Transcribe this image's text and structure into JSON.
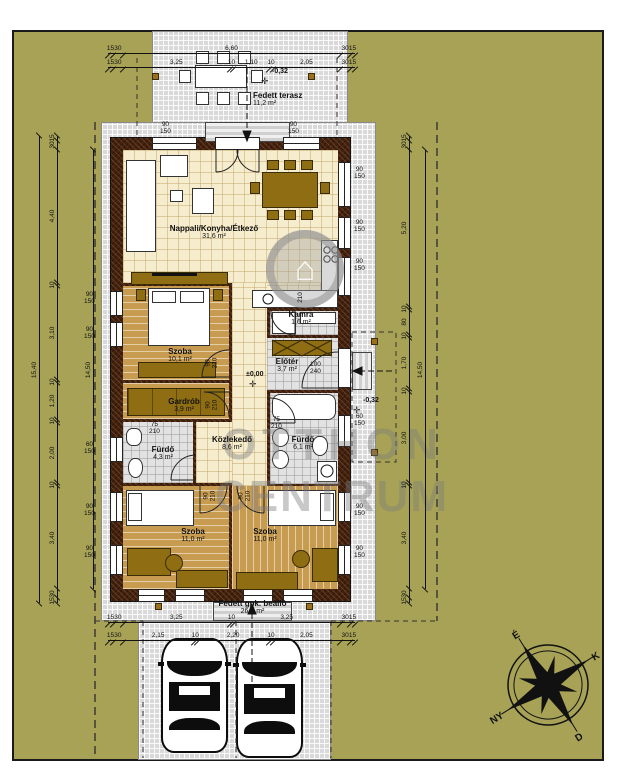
{
  "drawing": {
    "type": "floor-plan"
  },
  "colors": {
    "ground": "#a7a256",
    "paving": "#d9d9d9",
    "wall": "#45200a",
    "wood": "#c89c50",
    "cream": "#f6ecce",
    "furniture": "#8f6d12"
  },
  "rooms": [
    {
      "name": "Fedett terasz",
      "area": "11,2 m²"
    },
    {
      "name": "Nappali/Konyha/Étkező",
      "area": "31,6 m²"
    },
    {
      "name": "Szoba",
      "area": "10,1 m²"
    },
    {
      "name": "Gardrób",
      "area": "3,9 m²"
    },
    {
      "name": "Fürdő",
      "area": "4,3 m²"
    },
    {
      "name": "Közlekedő",
      "area": "8,6 m²"
    },
    {
      "name": "Kamra",
      "area": "1,6 m²"
    },
    {
      "name": "Előtér",
      "area": "3,7 m²"
    },
    {
      "name": "Fürdő",
      "area": "6,1 m²"
    },
    {
      "name": "Szoba",
      "area": "11,0 m²"
    },
    {
      "name": "Szoba",
      "area": "11,0 m²"
    },
    {
      "name": "Fedett gpk. beálló",
      "area": "26,7 m²"
    }
  ],
  "levels": [
    {
      "label": "-0,32",
      "mark": "✛"
    },
    {
      "label": "±0,00",
      "mark": "✛"
    },
    {
      "label": "-0,32",
      "mark": "✛"
    }
  ],
  "dimensions": {
    "top_outer": {
      "segments": [
        {
          "l": "15",
          "v": 15
        },
        {
          "l": "30",
          "v": 30
        },
        {
          "l": "6,60",
          "v": 660
        },
        {
          "l": "30",
          "v": 30
        },
        {
          "l": "15",
          "v": 15
        }
      ]
    },
    "top_inner": {
      "segments": [
        {
          "l": "15",
          "v": 15
        },
        {
          "l": "30",
          "v": 30
        },
        {
          "l": "3,25",
          "v": 325
        },
        {
          "l": "10",
          "v": 10
        },
        {
          "l": "1,10",
          "v": 110
        },
        {
          "l": "10",
          "v": 10
        },
        {
          "l": "2,05",
          "v": 205
        },
        {
          "l": "30",
          "v": 30
        },
        {
          "l": "15",
          "v": 15
        }
      ]
    },
    "bottom_outer": {
      "segments": [
        {
          "l": "15",
          "v": 15
        },
        {
          "l": "30",
          "v": 30
        },
        {
          "l": "3,25",
          "v": 325
        },
        {
          "l": "10",
          "v": 10
        },
        {
          "l": "3,25",
          "v": 325
        },
        {
          "l": "30",
          "v": 30
        },
        {
          "l": "15",
          "v": 15
        }
      ]
    },
    "bottom_inner": {
      "segments": [
        {
          "l": "15",
          "v": 15
        },
        {
          "l": "30",
          "v": 30
        },
        {
          "l": "2,15",
          "v": 215
        },
        {
          "l": "10",
          "v": 10
        },
        {
          "l": "2,20",
          "v": 220
        },
        {
          "l": "10",
          "v": 10
        },
        {
          "l": "2,05",
          "v": 205
        },
        {
          "l": "30",
          "v": 30
        },
        {
          "l": "15",
          "v": 15
        }
      ]
    },
    "left_detail": {
      "segments": [
        {
          "l": "15",
          "v": 15
        },
        {
          "l": "30",
          "v": 30
        },
        {
          "l": "4,40",
          "v": 440
        },
        {
          "l": "10",
          "v": 10
        },
        {
          "l": "3,10",
          "v": 310
        },
        {
          "l": "10",
          "v": 10
        },
        {
          "l": "1,20",
          "v": 120
        },
        {
          "l": "10",
          "v": 10
        },
        {
          "l": "2,00",
          "v": 200
        },
        {
          "l": "10",
          "v": 10
        },
        {
          "l": "3,40",
          "v": 340
        },
        {
          "l": "30",
          "v": 30
        },
        {
          "l": "15",
          "v": 15
        }
      ]
    },
    "left_total_outer": {
      "segments": [
        {
          "l": "15,40",
          "v": 1540
        }
      ]
    },
    "left_total_inner": {
      "segments": [
        {
          "l": "14,50",
          "v": 1450
        }
      ]
    },
    "right_detail": {
      "segments": [
        {
          "l": "15",
          "v": 15
        },
        {
          "l": "30",
          "v": 30
        },
        {
          "l": "5,20",
          "v": 520
        },
        {
          "l": "10",
          "v": 10
        },
        {
          "l": "80",
          "v": 80
        },
        {
          "l": "10",
          "v": 10
        },
        {
          "l": "1,70",
          "v": 170
        },
        {
          "l": "10",
          "v": 10
        },
        {
          "l": "3,00",
          "v": 300
        },
        {
          "l": "10",
          "v": 10
        },
        {
          "l": "3,40",
          "v": 340
        },
        {
          "l": "30",
          "v": 30
        },
        {
          "l": "15",
          "v": 15
        }
      ]
    },
    "right_total_inner": {
      "segments": [
        {
          "l": "14,50",
          "v": 1450
        }
      ]
    }
  },
  "openings": [
    {
      "a": "90",
      "b": "150"
    },
    {
      "a": "90",
      "b": "150"
    },
    {
      "a": "60",
      "b": "150"
    },
    {
      "a": "90",
      "b": "150"
    },
    {
      "a": "90",
      "b": "150"
    },
    {
      "a": "90",
      "b": "150"
    },
    {
      "a": "90",
      "b": "150"
    },
    {
      "a": "90",
      "b": "150"
    },
    {
      "a": "60",
      "b": "150"
    },
    {
      "a": "90",
      "b": "150"
    },
    {
      "a": "90",
      "b": "150"
    },
    {
      "a": "90",
      "b": "150"
    },
    {
      "a": "90",
      "b": "150"
    },
    {
      "a": "90",
      "b": "210"
    },
    {
      "a": "90",
      "b": "210"
    },
    {
      "a": "75",
      "b": "210"
    },
    {
      "a": "75",
      "b": "210"
    },
    {
      "a": "210",
      "b": ""
    },
    {
      "a": "100",
      "b": "240"
    },
    {
      "a": "90",
      "b": "210"
    },
    {
      "a": "90",
      "b": "210"
    }
  ],
  "compass": {
    "n": "É",
    "e": "K",
    "s": "D",
    "w": "NY"
  },
  "watermark": {
    "line1": "OTTHON",
    "line2": "CENTRUM",
    "logo": "⌂"
  }
}
